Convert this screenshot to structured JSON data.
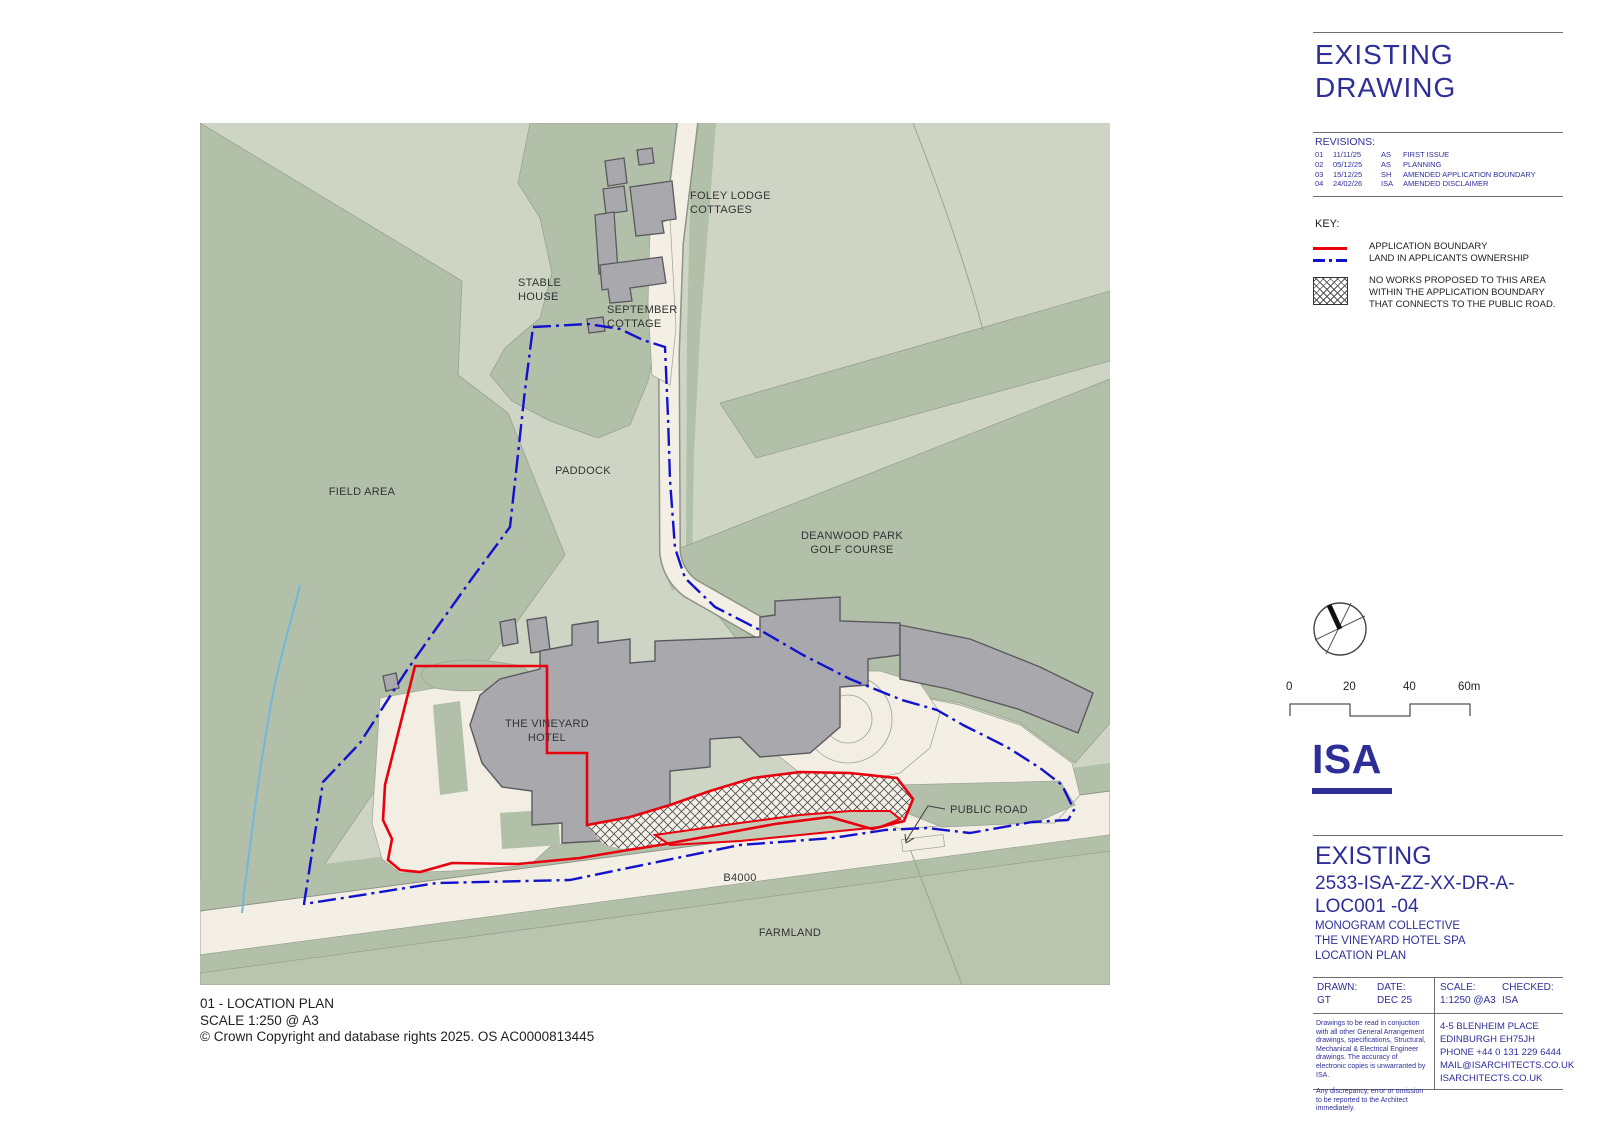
{
  "map": {
    "labels": {
      "foley_1": "FOLEY LODGE",
      "foley_2": "COTTAGES",
      "stable_1": "STABLE",
      "stable_2": "HOUSE",
      "september_1": "SEPTEMBER",
      "september_2": "COTTAGE",
      "paddock": "PADDOCK",
      "field_area": "FIELD AREA",
      "deanwood_1": "DEANWOOD PARK",
      "deanwood_2": "GOLF COURSE",
      "hotel_1": "THE VINEYARD",
      "hotel_2": "HOTEL",
      "public_road": "PUBLIC ROAD",
      "b4000": "B4000",
      "farmland": "FARMLAND"
    },
    "caption": {
      "line1": "01 - LOCATION PLAN",
      "line2": "SCALE 1:250 @ A3",
      "line3": "© Crown Copyright and database rights 2025. OS AC0000813445"
    }
  },
  "titleblock": {
    "header_line1": "EXISTING",
    "header_line2": "DRAWING",
    "revisions": {
      "title": "REVISIONS:",
      "rows": [
        {
          "no": "01",
          "date": "11/11/25",
          "by": "AS",
          "desc": "FIRST ISSUE"
        },
        {
          "no": "02",
          "date": "05/12/25",
          "by": "AS",
          "desc": "PLANNING"
        },
        {
          "no": "03",
          "date": "15/12/25",
          "by": "SH",
          "desc": "AMENDED APPLICATION BOUNDARY"
        },
        {
          "no": "04",
          "date": "24/02/26",
          "by": "ISA",
          "desc": "AMENDED DISCLAIMER"
        }
      ]
    },
    "key": {
      "title": "KEY:",
      "application_boundary": "APPLICATION BOUNDARY",
      "ownership": "LAND IN APPLICANTS OWNERSHIP",
      "no_works_1": "NO WORKS PROPOSED TO THIS AREA",
      "no_works_2": "WITHIN THE APPLICATION BOUNDARY",
      "no_works_3": "THAT CONNECTS TO THE PUBLIC ROAD."
    },
    "scalebar": {
      "t0": "0",
      "t20": "20",
      "t40": "40",
      "t60": "60m"
    },
    "logo": "ISA",
    "drawing": {
      "status": "EXISTING",
      "number_line1": "2533-ISA-ZZ-XX-DR-A-",
      "number_line2": "LOC001 -04",
      "client": "MONOGRAM COLLECTIVE",
      "project": "THE VINEYARD  HOTEL SPA",
      "sheet": "LOCATION PLAN"
    },
    "meta": {
      "drawn_label": "DRAWN:",
      "drawn": "GT",
      "date_label": "DATE:",
      "date": "DEC 25",
      "scale_label": "SCALE:",
      "scale": "1:1250 @A3",
      "checked_label": "CHECKED:",
      "checked": "ISA"
    },
    "disclaimer": {
      "para1": "Drawings to be read in conjuction with all other General Arrangement drawings, specifications, Structural, Mechanical & Electrical Engineer drawings. The accuracy of electronic copies is unwarranted by ISA.",
      "para2": "Any discrepancy, error or omission to be reported to the Architect immediately."
    },
    "address": {
      "line1": "4-5 BLENHEIM PLACE",
      "line2": "EDINBURGH EH75JH",
      "line3": "PHONE +44 0 131 229 6444",
      "line4": "MAIL@ISARCHITECTS.CO.UK",
      "line5": "ISARCHITECTS.CO.UK"
    }
  },
  "colors": {
    "accent_navy": "#2e2e99",
    "boundary_red": "#e8000e",
    "ownership_blue": "#1212cc",
    "map_green_light": "#cfd5c5",
    "map_green_mid": "#b2bfa9",
    "map_road_cream": "#f3efe4",
    "building_gray": "#a9a9ad",
    "stream_blue": "#72b7dc"
  }
}
